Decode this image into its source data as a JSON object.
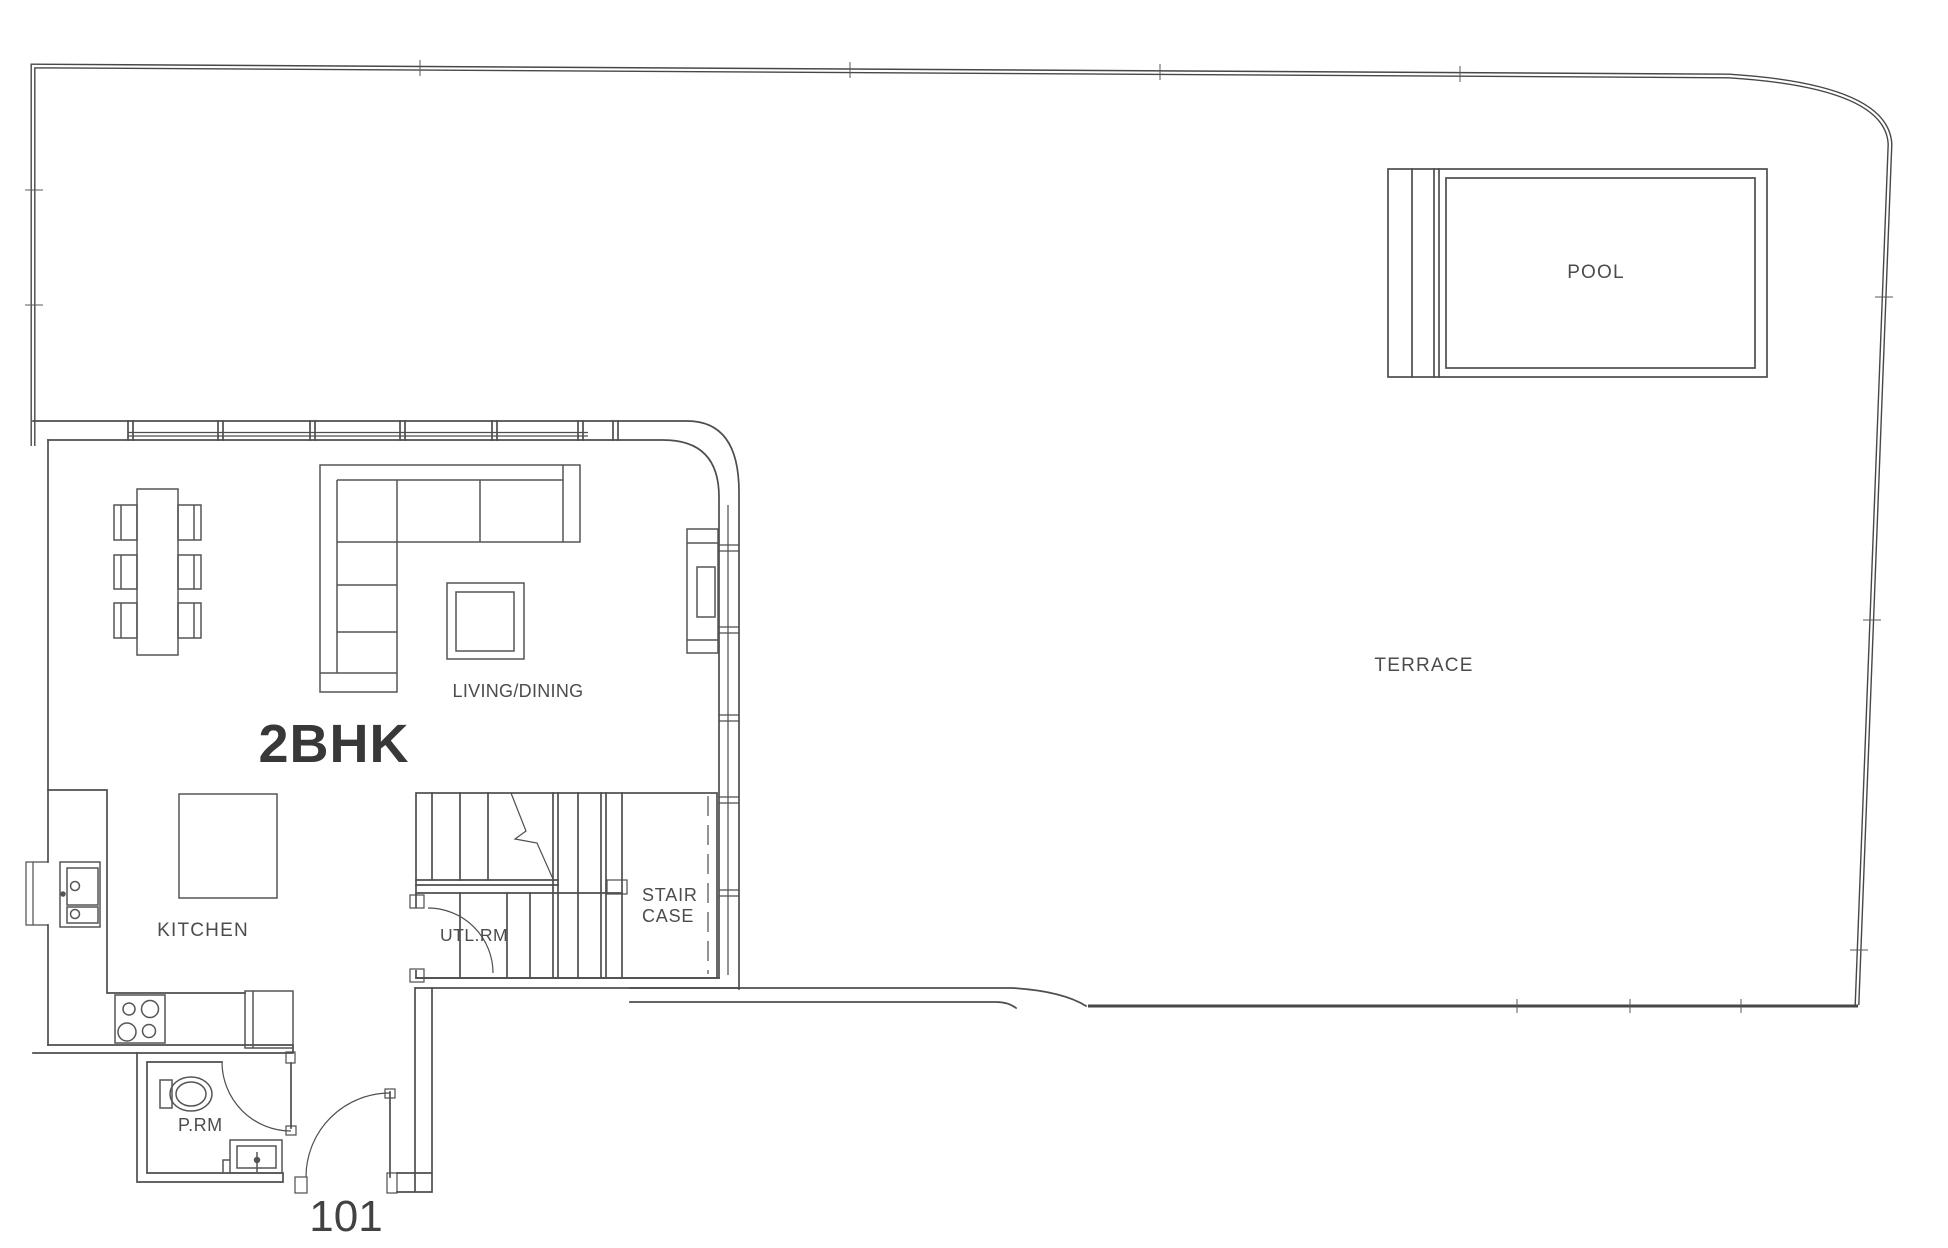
{
  "plan": {
    "unit_type_label": "2BHK",
    "unit_number_label": "101",
    "labels": {
      "pool": "POOL",
      "terrace": "TERRACE",
      "living_dining": "LIVING/DINING",
      "kitchen": "KITCHEN",
      "staircase_line_1": "STAIR",
      "staircase_line_2": "CASE",
      "utility_room": "UTL.RM",
      "powder_room": "P.RM"
    },
    "colors": {
      "background": "#ffffff",
      "line": "#4e4e4e",
      "boundary": "#474747",
      "label_text": "#4c4c4c",
      "title_text": "#383838"
    }
  }
}
